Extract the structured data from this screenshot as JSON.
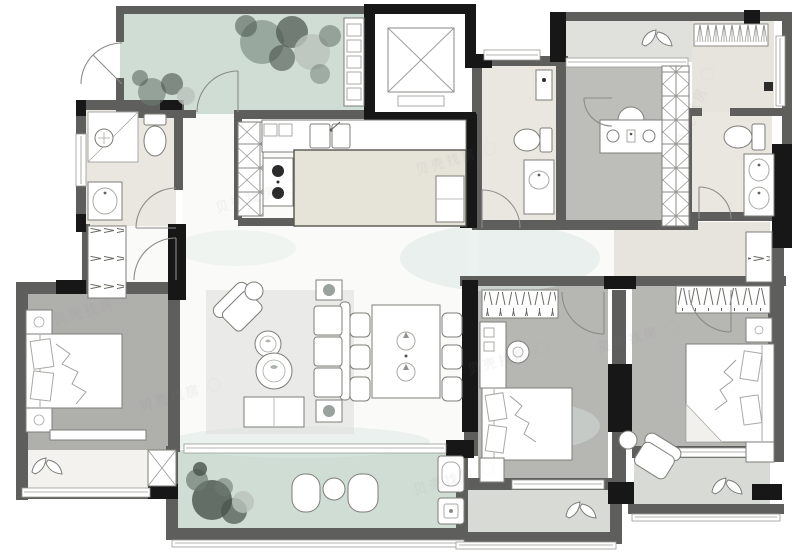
{
  "meta": {
    "type": "floor-plan",
    "style": "rendered real-estate apartment plan, top-down view",
    "visible_text": "none (no printed room labels or dimensions; only faint repeated watermarks)"
  },
  "palette": {
    "wall": "#5e5e5c",
    "column": "#171717",
    "wallLight": "#8f8f8c",
    "white": "#ffffff",
    "stroke": "#7d7d79",
    "strokeSoft": "#a9a9a5",
    "floorWhite": "#fafaf8",
    "floorCream": "#eae7e0",
    "floorBeige": "#e6e4dd",
    "floorGray": "#b6b6b3",
    "floorGrayDark": "#afafac",
    "floorStudy": "#bdbdba",
    "green": "#cfddd4",
    "balconyGray": "#d8dad6",
    "balconyTop": "#e0e0dd",
    "island": "#e6e3d9",
    "rug": "#dcddda",
    "washTeal": "#dce8e3",
    "plantDark": "#47534b",
    "plantMid": "#6e7b72",
    "plantLight": "#b9c3bb",
    "watermark": "#8e8291"
  },
  "watermark": {
    "text": "贝壳找房",
    "logo": "◯",
    "instances": [
      {
        "x": 52,
        "y": 298,
        "rot": -16
      },
      {
        "x": 138,
        "y": 384,
        "rot": -16
      },
      {
        "x": 414,
        "y": 148,
        "rot": -16
      },
      {
        "x": 466,
        "y": 348,
        "rot": -16
      },
      {
        "x": 596,
        "y": 326,
        "rot": -16
      },
      {
        "x": 652,
        "y": 96,
        "rot": -70
      },
      {
        "x": 412,
        "y": 468,
        "rot": -16
      },
      {
        "x": 214,
        "y": 186,
        "rot": -16
      }
    ]
  },
  "rooms": [
    {
      "id": "entry-porch",
      "features": [
        "green floor",
        "plant clusters",
        "shoe cabinet",
        "entry gate door"
      ]
    },
    {
      "id": "elevator",
      "features": [
        "black shaft walls",
        "X elevator symbol"
      ]
    },
    {
      "id": "foyer",
      "features": [
        "entry door arc",
        "hanger wardrobe"
      ]
    },
    {
      "id": "bathroom-1",
      "features": [
        "shower",
        "toilet",
        "washbasin",
        "side window"
      ]
    },
    {
      "id": "kitchen",
      "features": [
        "tall X cabinet",
        "double sink",
        "two-burner stove",
        "beige island counter"
      ]
    },
    {
      "id": "dining",
      "features": [
        "table",
        "6 chairs",
        "two decor pieces"
      ]
    },
    {
      "id": "living",
      "features": [
        "corner armchair",
        "two round coffee tables",
        "three-seat sofa",
        "side tables",
        "bench",
        "rug"
      ]
    },
    {
      "id": "master-bedroom",
      "features": [
        "double bed",
        "2 nightstands",
        "foot bench",
        "bay window with leaf decor"
      ]
    },
    {
      "id": "main-balcony",
      "features": [
        "green floor",
        "plant cluster",
        "2 lounge chairs",
        "round table",
        "utility sink",
        "washer"
      ]
    },
    {
      "id": "bedroom-2",
      "features": [
        "hanger wardrobe",
        "dresser with stool",
        "double bed",
        "nightstand",
        "balcony with leaf decor"
      ]
    },
    {
      "id": "bedroom-3",
      "features": [
        "hanger wardrobe",
        "double bed",
        "2 nightstands",
        "armchair",
        "balcony with leaf decor"
      ]
    },
    {
      "id": "study",
      "features": [
        "desk",
        "chair",
        "tall X wardrobe strip"
      ]
    },
    {
      "id": "top-balcony",
      "features": [
        "double-leaf decor"
      ]
    },
    {
      "id": "bathroom-2",
      "features": [
        "small window",
        "wall basin",
        "toilet",
        "vanity"
      ]
    },
    {
      "id": "bathroom-3",
      "features": [
        "toilet",
        "double-basin vanity"
      ]
    },
    {
      "id": "top-right-room",
      "features": [
        "closet band",
        "wall fixture"
      ]
    },
    {
      "id": "dressing-corridor",
      "features": [
        "hanger cabinet"
      ]
    }
  ]
}
